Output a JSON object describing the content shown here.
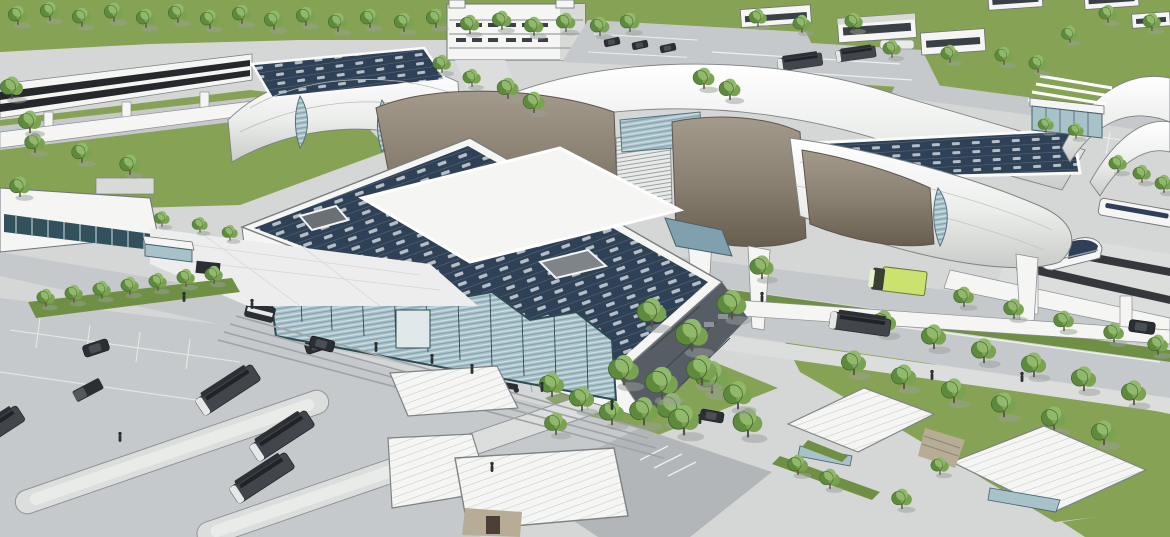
{
  "meta": {
    "title": "Aerial architectural rendering of an intermodal transit station",
    "medium": "3D SketchUp-style visualization",
    "view": "oblique aerial"
  },
  "scene": {
    "description": "Aerial rendering of an elevated rail station: a long curved canopy with alternating white barrel-vault roofs and taupe shell segments, glass clerestory gaps and rooftop solar arrays, spanning elevated tracks with two white high-speed trains. In front sits the main terminal building with a solar-panel roof, raised clerestory, skylight and a zigzag teal-glass entrance canopy over wide steps. Surroundings include a multi-storey parking garage, surface parking with cars, low retail buildings, a bus depot, a bus loop with three grey buses on island platforms, ribbed-roof drop-off pavilions, lawns with regular rows of trees, roads with a green box truck, a grey bus and dark cars, and a glass pavilion beside a pedestrian plaza.",
    "objects": [
      "elevated-rail-guideway",
      "station-canopy",
      "solar-arrays",
      "main-terminal",
      "zigzag-glass-entrance",
      "entrance-steps",
      "parking-garage",
      "surface-parking",
      "retail-buildings",
      "bus-depot",
      "bus-loop-islands",
      "buses",
      "green-box-truck",
      "high-speed-trains",
      "glass-pavilion",
      "plaza-kiosk",
      "drop-off-pavilions",
      "lawn-tree-rows",
      "roads",
      "pedestrians",
      "cars",
      "police-van",
      "motorcycle"
    ],
    "counts": {
      "loop_buses": 3,
      "trains_visible": 2,
      "green_trucks": 1,
      "taupe_canopy_shells": 3
    }
  },
  "colors": {
    "grass": "#86a254",
    "grassDark": "#6f8f45",
    "tree1": "#5d8a3c",
    "tree2": "#79a351",
    "tree3": "#91b96b",
    "treeLine": "#41602c",
    "trunk": "#5a5148",
    "ground": "#d5d7d6",
    "road": "#c6c9cc",
    "roadDark": "#b2b6b9",
    "pave": "#dcdedd",
    "plaza": "#ecedec",
    "white": "#f5f6f4",
    "whiteShade": "#d8dad8",
    "outline": "#585d62",
    "lineLight": "#aeb2b5",
    "solar": "#2e4156",
    "solarGap": "#b6bfc7",
    "solarFrame": "#8d979e",
    "brown": "#8b8173",
    "brownDark": "#6e6557",
    "brownLight": "#a2988a",
    "glass": "#a8c2ca",
    "glassDark": "#33515d",
    "glassMid": "#7fa0ac",
    "facadeDark": "#575d64",
    "beige": "#b7ad96",
    "darkVeh": "#2b2e32",
    "busGray": "#41464c",
    "truckGreen": "#cbe170",
    "trainBlue": "#2f3f58",
    "shadow": "#a9adb0"
  }
}
